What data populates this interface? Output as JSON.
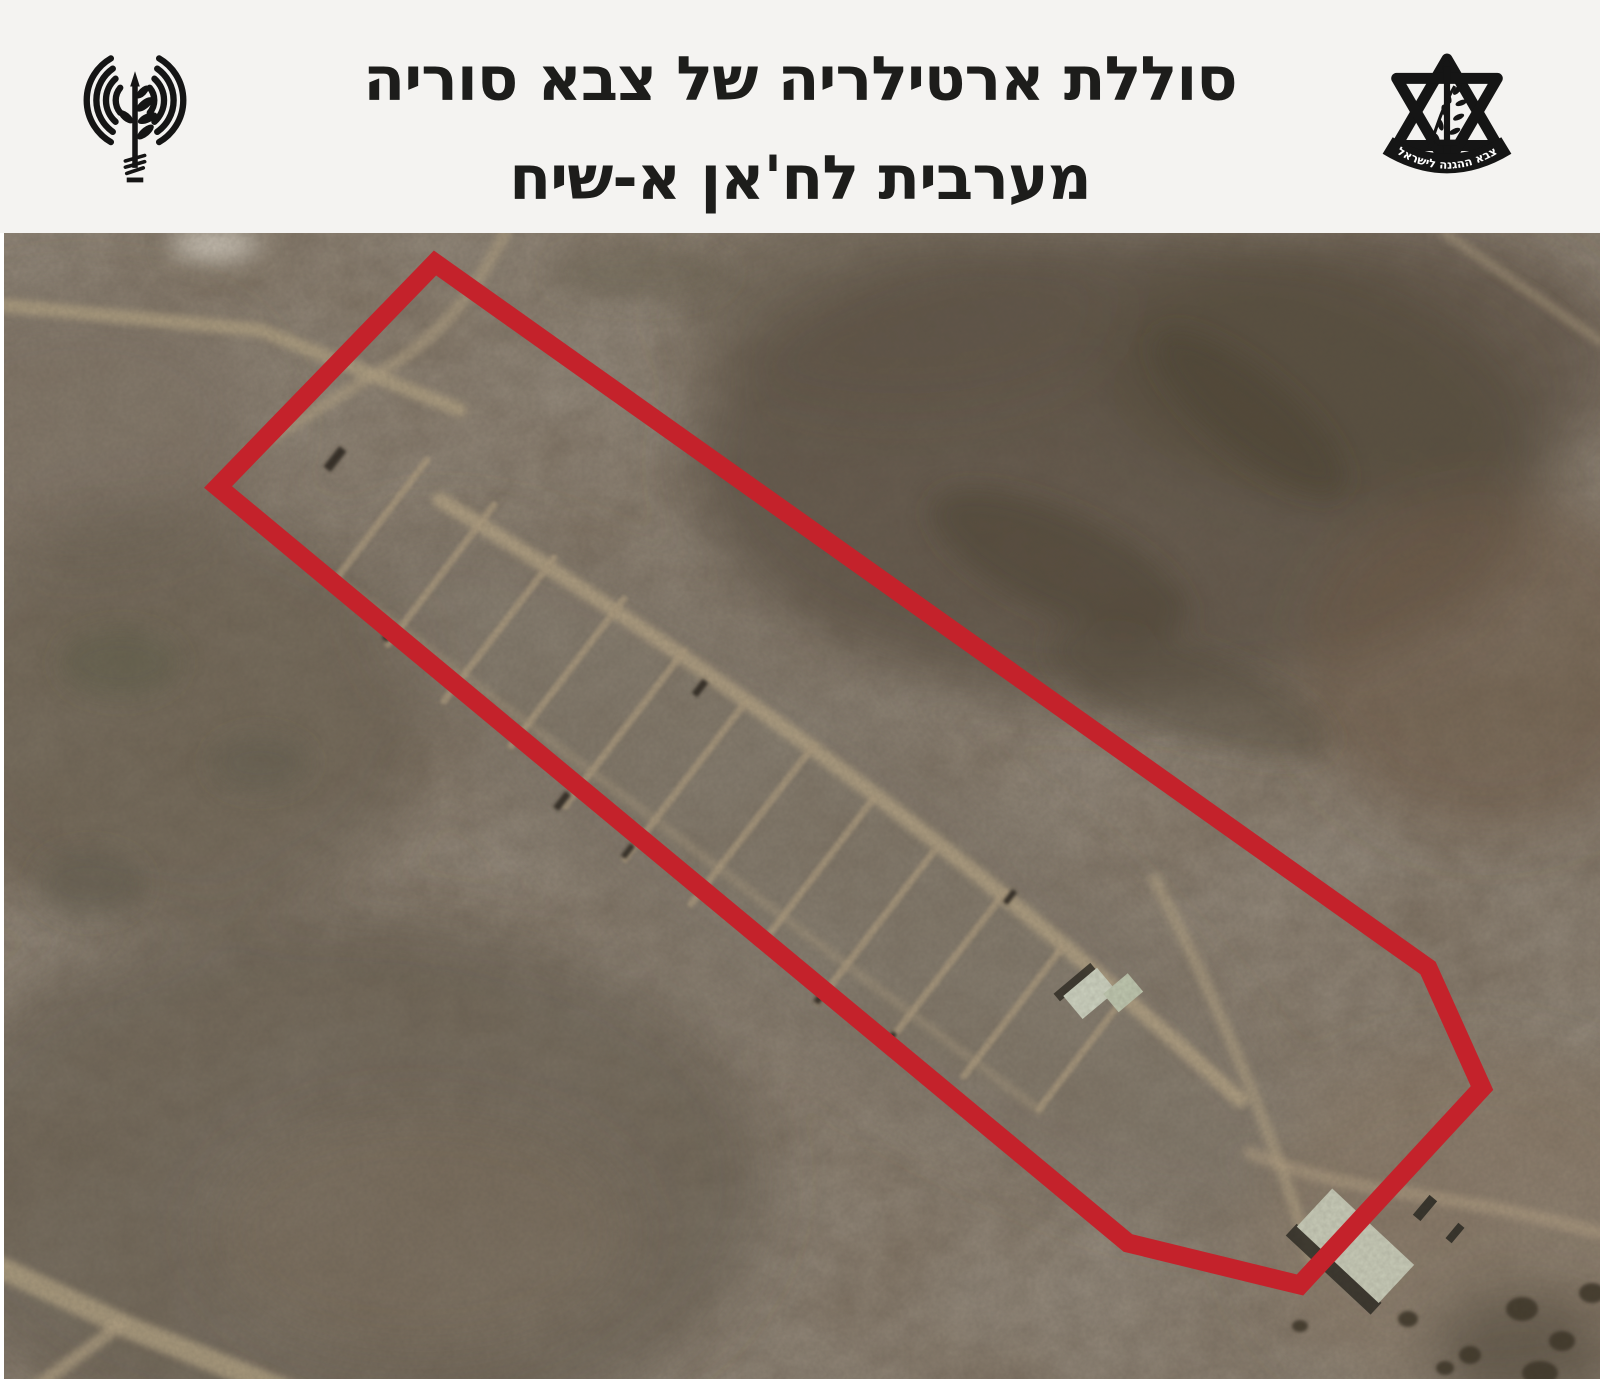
{
  "header": {
    "title_line1": "סוללת ארטילריה של צבא סוריה",
    "title_line2": "מערבית לח'אן א-שיח",
    "background": "#f4f3f1",
    "text_color": "#1d1d1b",
    "left_logo": "idf-spokesperson-antenna-waves-olive-branch",
    "right_logo": "idf-emblem-star-of-david-sword-olive-branch",
    "right_logo_ribbon_text": "צבא ההגנה לישראל"
  },
  "annotation": {
    "shape": "polygon-outline",
    "color": "#c4222b",
    "stroke_width": 19,
    "polygon_points": "435,30 218,254 1128,1010 1300,1052 1482,855 1428,735"
  }
}
